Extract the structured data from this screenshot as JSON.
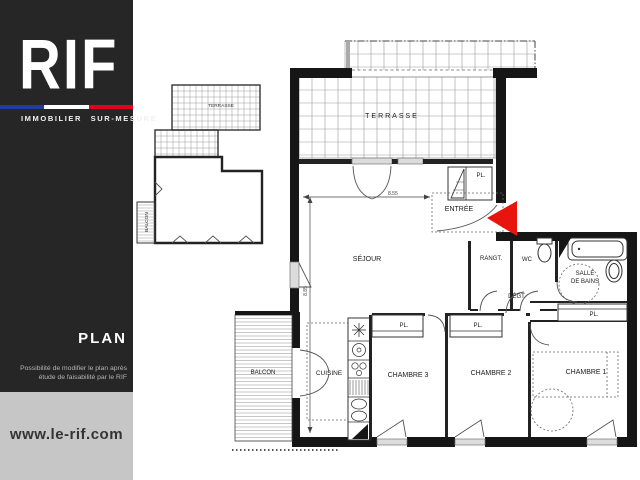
{
  "sidebar": {
    "logo": "RIF",
    "tagline": "IMMOBILIER SUR-MESURE",
    "section_title": "PLAN",
    "note_line1": "Possibilité de modifier le plan après",
    "note_line2": "étude de faisabilité par le RIF",
    "website": "www.le-rif.com",
    "colors": {
      "background": "#262626",
      "footer_background": "#c6c6c6",
      "flag_blue": "#1e3e9e",
      "flag_white": "#ffffff",
      "flag_red": "#e2001a"
    }
  },
  "plan": {
    "labels": {
      "terrasse": "TERRASSE",
      "entree": "ENTRÉE",
      "sejour": "SÉJOUR",
      "rangt": "RANGT.",
      "wc": "WC",
      "salle_line1": "SALLE",
      "salle_line2": "DE BAINS",
      "degt": "DÉGT.",
      "pl": "PL.",
      "cuisine": "CUISINE",
      "chambre3": "CHAMBRE 3",
      "chambre2": "CHAMBRE 2",
      "chambre1": "CHAMBRE 1",
      "balcon": "BALCON"
    },
    "dimensions": {
      "width": "8.55",
      "height": "8.85"
    },
    "colors": {
      "walls": "#161616",
      "hatch": "#9a9a9a",
      "entrance_arrow": "#e8140e"
    }
  },
  "mini_plan": {
    "terrasse": "TERRASSE",
    "balcon": "BALCON"
  }
}
